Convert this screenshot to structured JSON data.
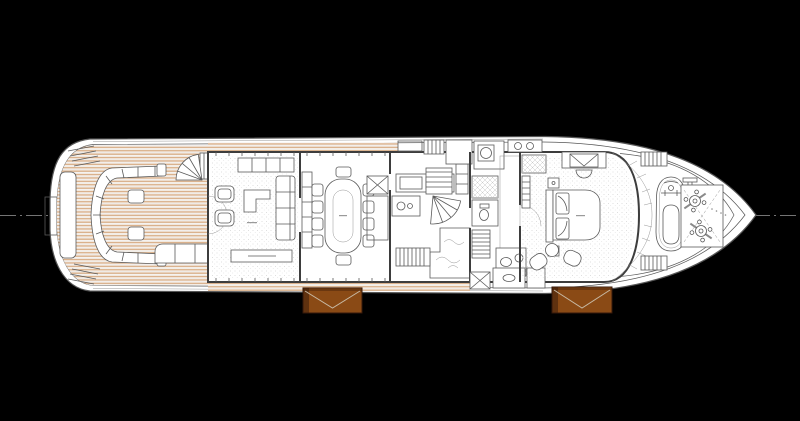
{
  "plan": {
    "title": "motor-yacht-main-deck-general-arrangement",
    "type": "deck-plan",
    "orientation": "bow-right",
    "colors": {
      "background": "#000000",
      "paper": "#ffffff",
      "hull": "#565656",
      "wall": "#3d3d3d",
      "line": "#5a5a5a",
      "centerline": "#9a9a9a",
      "teak": "#d9b08b",
      "teak_joint": "#cfc4b8",
      "carpet_dot": "#d4d4d4",
      "balcony": "#8a4a15",
      "balcony_border": "#34180a",
      "balcony_fold": "#c7b9a4"
    },
    "regions": [
      {
        "id": "swim-platform"
      },
      {
        "id": "aft-deck-lounge"
      },
      {
        "id": "main-salon"
      },
      {
        "id": "dining-room"
      },
      {
        "id": "galley"
      },
      {
        "id": "day-head"
      },
      {
        "id": "corridor-and-heads"
      },
      {
        "id": "owners-cabin"
      },
      {
        "id": "foredeck"
      },
      {
        "id": "anchor-windlass-area"
      },
      {
        "id": "fold-down-balcony-aft"
      },
      {
        "id": "fold-down-balcony-forward"
      }
    ]
  }
}
